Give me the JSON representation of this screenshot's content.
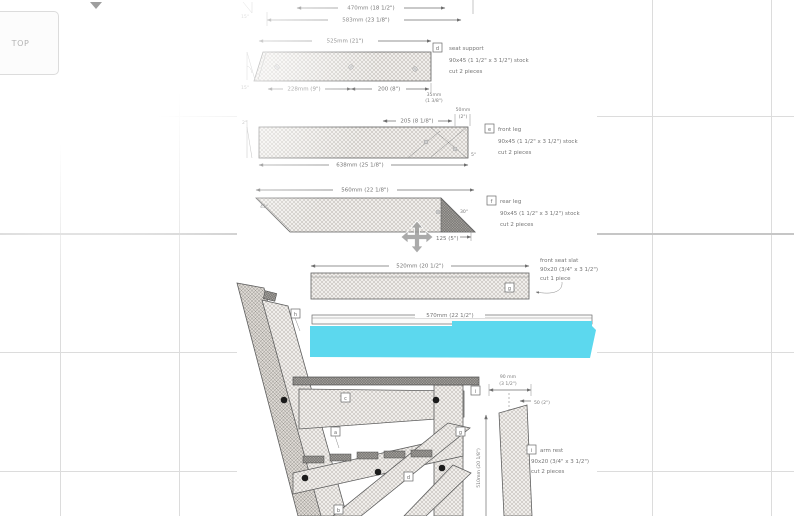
{
  "colors": {
    "highlight": "#5cd8ee"
  },
  "viewport_controls": {
    "view_cube_label": "TOP"
  },
  "drawing": {
    "top_part": {
      "dim_inner": "470mm (18 1/2\")",
      "dim_outer": "583mm (23 1/8\")",
      "angle": "15°"
    },
    "seat_support": {
      "letter": "d",
      "name": "seat support",
      "stock": "90x45 (1 1/2\" x 3 1/2\") stock",
      "cut": "cut 2 pieces",
      "dim_top": "525mm (21\")",
      "dim_bottom_left": "228mm (9\")",
      "dim_bottom_right": "200 (8\")",
      "dim_end_1": "35mm",
      "dim_end_2": "(1 3/8\")",
      "angle": "15°"
    },
    "front_leg": {
      "letter": "e",
      "name": "front leg",
      "stock": "90x45 (1 1/2\" x 3 1/2\") stock",
      "cut": "cut 2 pieces",
      "dim_top": "205 (8 1/8\")",
      "dim_end_1": "50mm",
      "dim_end_2": "(2\")",
      "dim_bottom": "638mm (25 1/8\")",
      "angle_left": "2°",
      "angle_right": "5°"
    },
    "rear_leg": {
      "letter": "f",
      "name": "rear leg",
      "stock": "90x45 (1 1/2\" x 3 1/2\") stock",
      "cut": "cut 2 pieces",
      "dim_top": "560mm (22 1/8\")",
      "dim_bottom": "125 (5\")",
      "angle_left": "45°",
      "angle_right": "30°"
    },
    "front_seat_slat": {
      "letter": "g",
      "name": "front seat slat",
      "stock": "90x20 (3/4\" x 3 1/2\")",
      "cut": "cut 1 piece",
      "dim_top": "520mm (20 1/2\")"
    },
    "rear_seat_slat": {
      "letter": "h",
      "dim": "570mm (22 1/2\")"
    },
    "arm_rest": {
      "letter": "i",
      "name": "arm rest",
      "stock": "90x20 (3/4\" x 3 1/2\")",
      "cut": "cut 2 pieces",
      "dim_width_1": "90 mm",
      "dim_width_2": "(3 1/2\")",
      "dim_offset": "50 (2\")",
      "dim_height": "510mm (20 1/8\")"
    },
    "side_view_labels": {
      "rail_upper": "c",
      "rail_lower": "a",
      "brace": "g",
      "seat_support": "d",
      "back_foot": "b",
      "armrest": "i"
    }
  }
}
